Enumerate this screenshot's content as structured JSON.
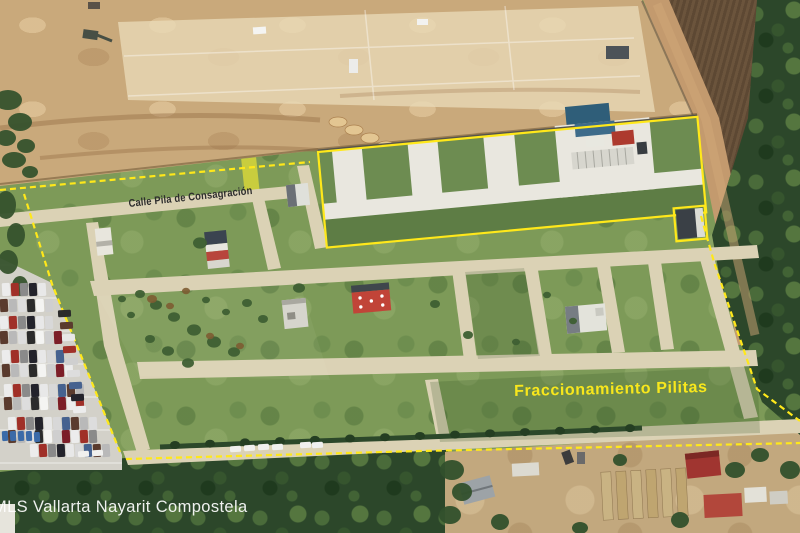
{
  "overlays": {
    "street_label": "Calle Pila de Consagración",
    "development_label": "Fraccionamiento Pilitas",
    "watermark": "MLS Vallarta Nayarit Compostela"
  },
  "colors": {
    "boundary_yellow": "#ffe81a",
    "development_label_yellow": "#f8e71c",
    "street_label_dark": "#2e2e2e",
    "watermark_white": "#ffffff"
  }
}
